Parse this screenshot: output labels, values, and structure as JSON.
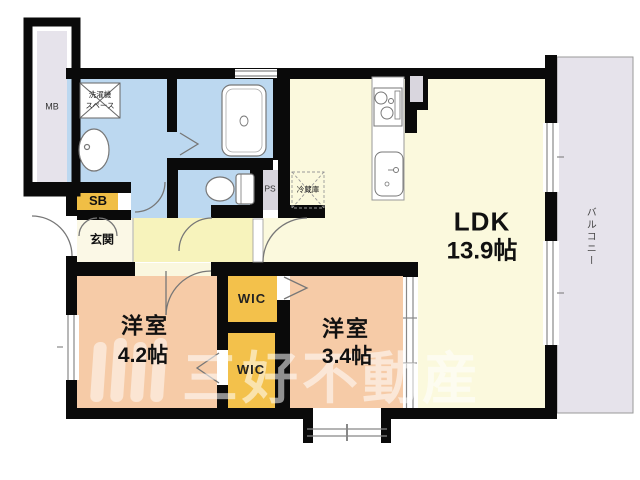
{
  "floorplan": {
    "rooms": {
      "ldk": {
        "label": "LDK",
        "size": "13.9帖"
      },
      "bedroom_left": {
        "label": "洋室",
        "size": "4.2帖"
      },
      "bedroom_right": {
        "label": "洋室",
        "size": "3.4帖"
      },
      "wic_upper": {
        "label": "WIC"
      },
      "wic_lower": {
        "label": "WIC"
      },
      "entrance": {
        "label": "玄関"
      },
      "balcony": {
        "label": "バルコニー"
      }
    },
    "compartments": {
      "meter_box": "MB",
      "shoe_box": "SB",
      "pipe_space": "PS"
    },
    "fixtures": {
      "washer_space_line1": "洗濯機",
      "washer_space_line2": "スペース",
      "refrigerator": "冷蔵庫"
    },
    "watermark": {
      "company": "三好不動産"
    },
    "colors": {
      "wall": "#0a0a0a",
      "sanitary_blue": "#bcd8f0",
      "ldk_cream": "#fbf9dd",
      "hall_yellow": "#f7f3bc",
      "genkan_cream": "#fbf8e6",
      "bedroom_peach": "#f6cba7",
      "wic_yellow": "#f3c14b",
      "sb_yellow": "#f0be45",
      "gray_zone": "#e6e3eb",
      "ps_gray": "#d9d6de",
      "fixture_line": "#777777"
    }
  }
}
